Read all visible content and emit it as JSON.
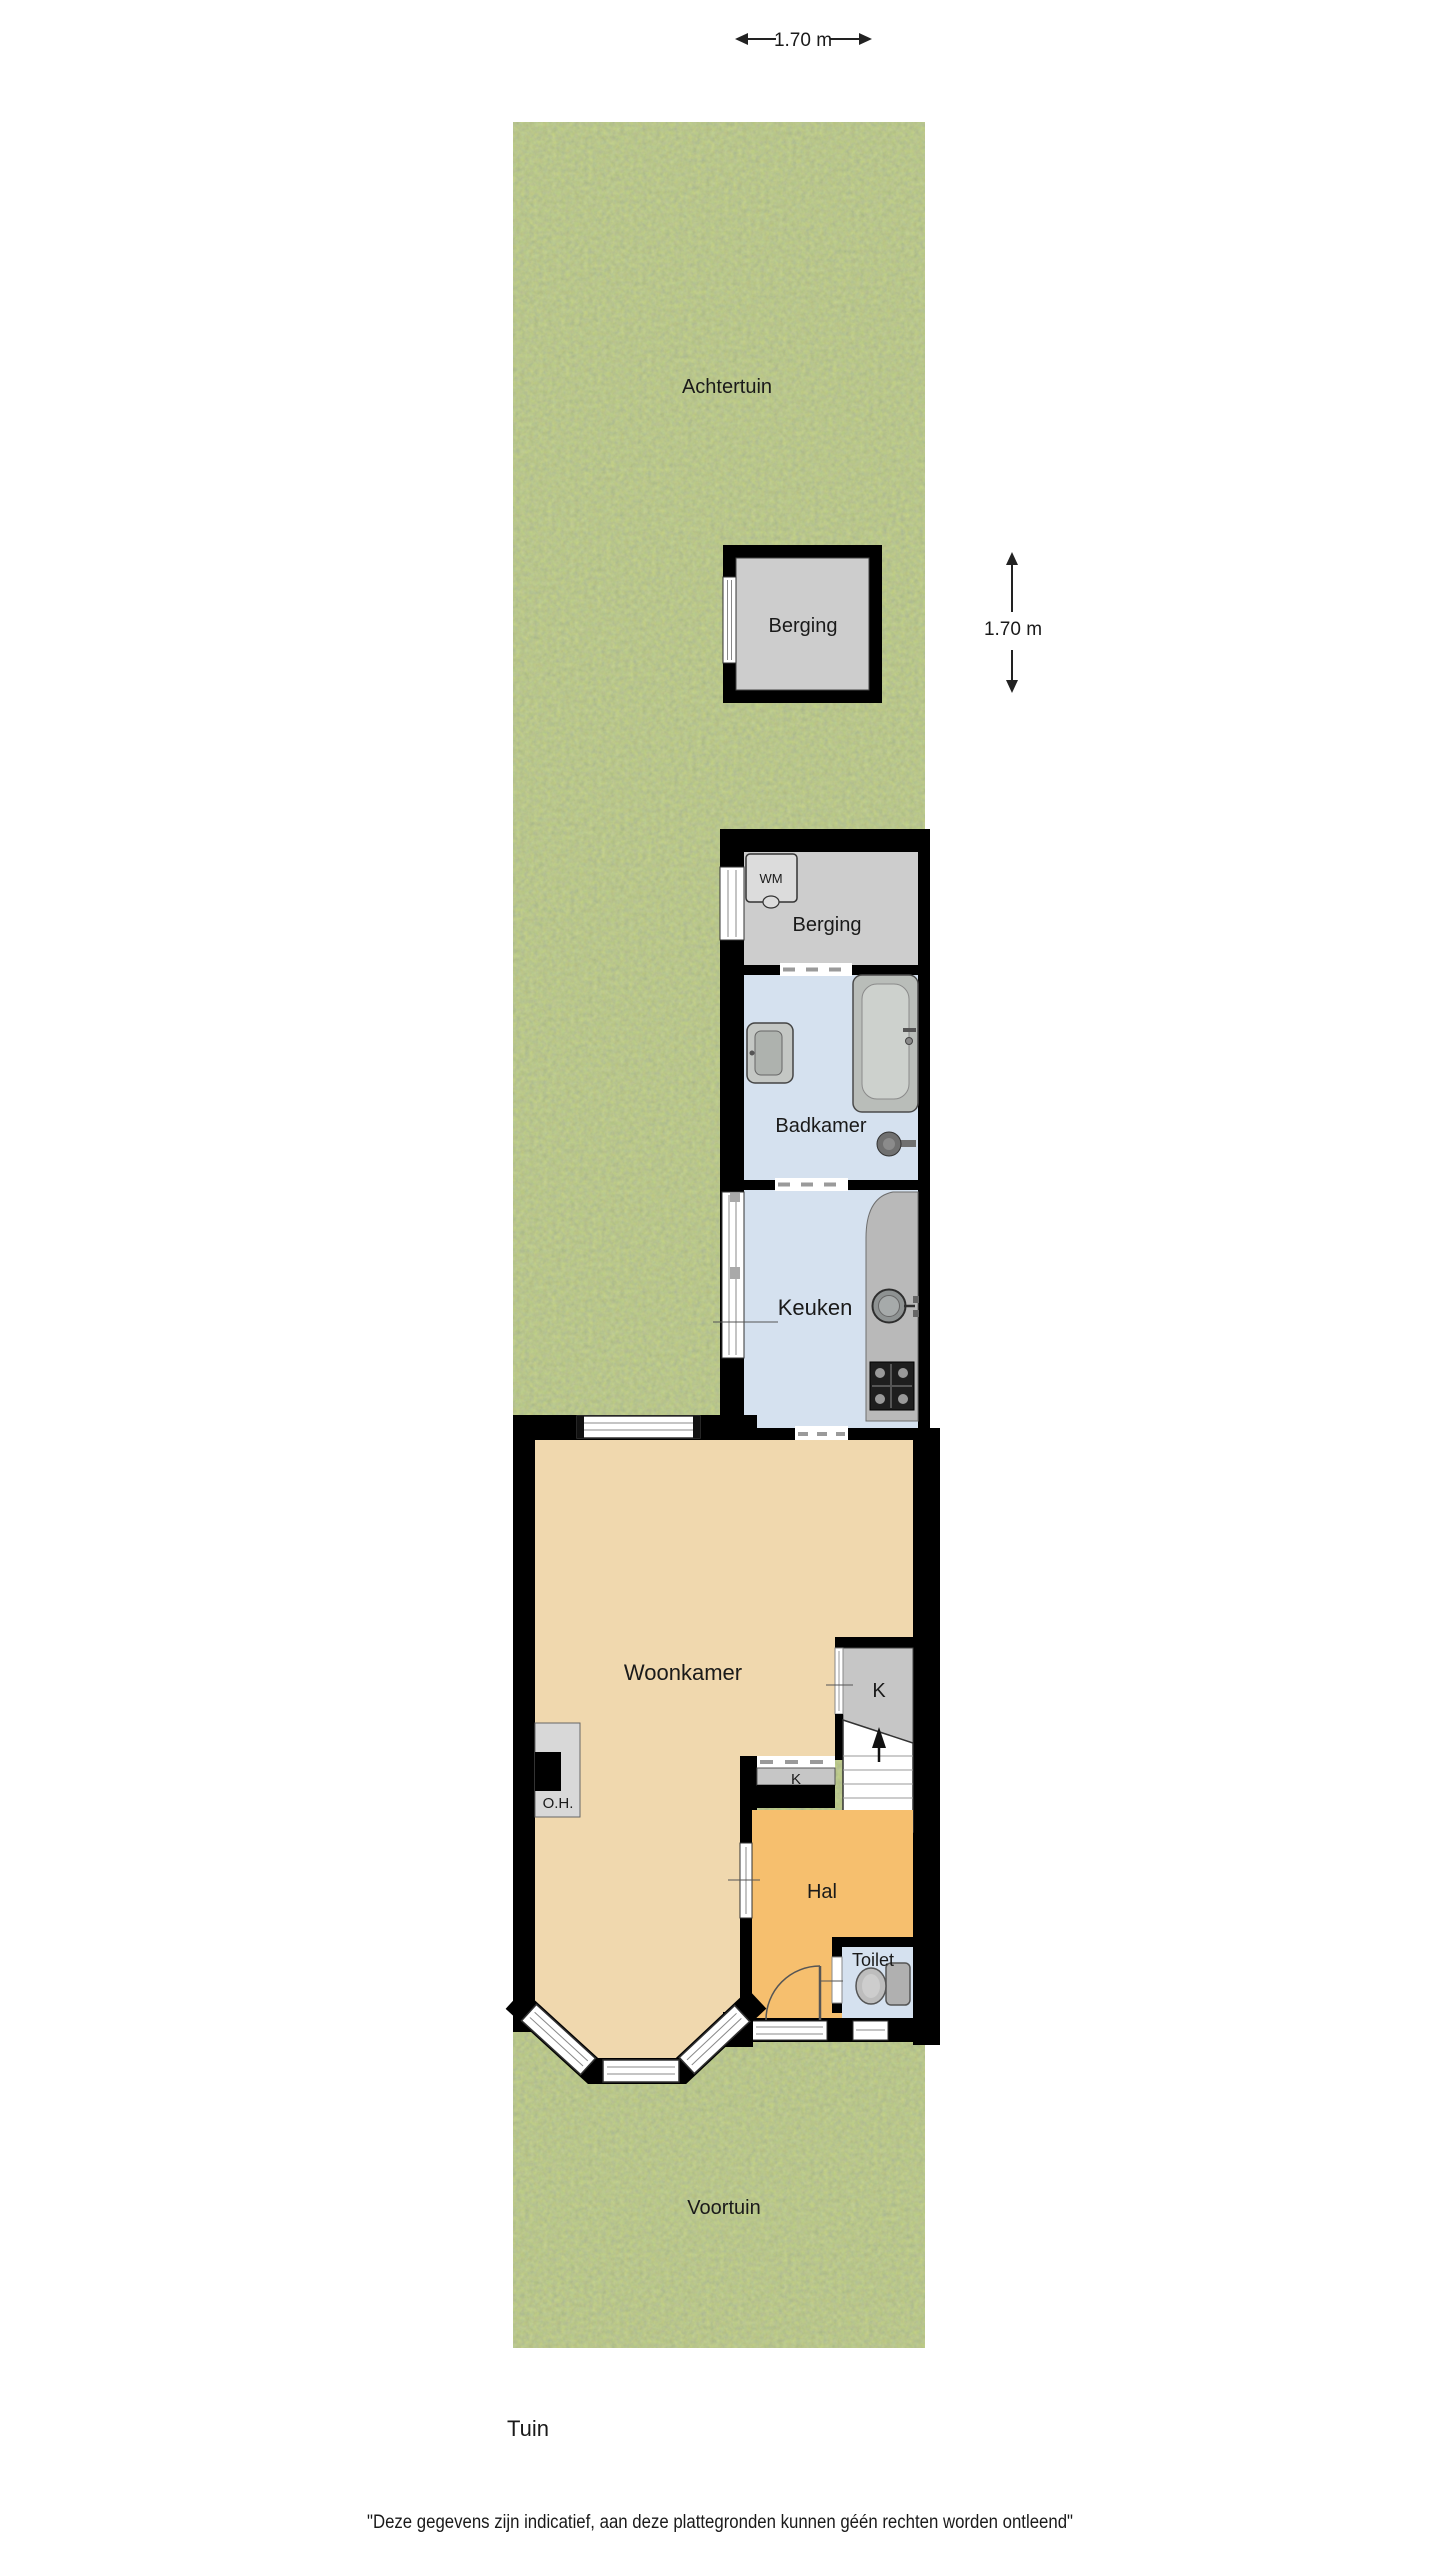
{
  "plan": {
    "type": "floorplan",
    "labels": {
      "achtertuin": "Achtertuin",
      "shed_berging": "Berging",
      "house_berging": "Berging",
      "badkamer": "Badkamer",
      "keuken": "Keuken",
      "woonkamer": "Woonkamer",
      "hal": "Hal",
      "toilet": "Toilet",
      "voortuin": "Voortuin",
      "closet_k": "K",
      "closet_k_small": "K",
      "open_haard": "O.H.",
      "washer": "WM",
      "tuin": "Tuin"
    },
    "dimensions": {
      "top_width": "1.70 m",
      "right_height": "1.70 m"
    },
    "footer": {
      "disclaimer": "\"Deze gegevens zijn indicatief, aan deze plattegronden kunnen géén rechten worden ontleend\""
    },
    "colors": {
      "wall": "#000000",
      "grass_base": "#7b8e42",
      "woonkamer_floor": "#f0d8ae",
      "hal_floor": "#f6bf6e",
      "wet_room_floor": "#d5e1ef",
      "berging_floor": "#cdcdcd",
      "closet_floor": "#c6c6c6",
      "counter": "#b9b9b9",
      "fixture_gray": "#b9bdb9",
      "stove": "#1e1e1e",
      "label_text": "#1a1a1a"
    }
  }
}
